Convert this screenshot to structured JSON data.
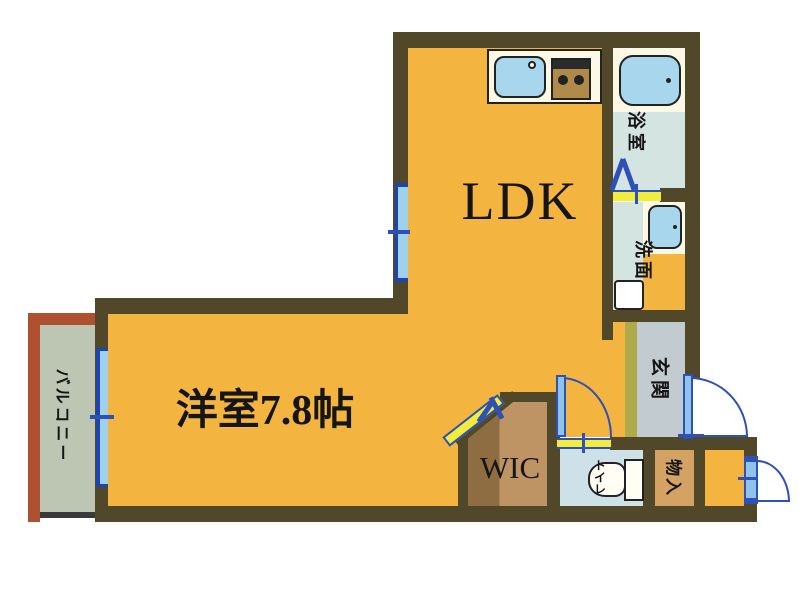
{
  "rooms": {
    "ldk": {
      "label": "LDK"
    },
    "bedroom": {
      "label": "洋室7.8帖"
    },
    "wic": {
      "label": "WIC"
    },
    "balcony": {
      "label": "バルコニー"
    },
    "bathroom": {
      "label": "浴室"
    },
    "washroom": {
      "label": "洗面"
    },
    "entrance": {
      "label": "玄関"
    },
    "storage": {
      "label": "物入"
    },
    "toilet": {
      "label": "トイレ"
    }
  },
  "fixtures": [
    "kitchen-sink",
    "gas-stove",
    "bathtub",
    "washbasin",
    "toilet-bowl",
    "washing-machine-pan"
  ],
  "doors": [
    "entrance-swing-door",
    "toilet-swing-door",
    "storage-swing-door",
    "bath-folding-door",
    "wic-folding-door"
  ],
  "windows": [
    "ldk-window",
    "balcony-sliding-window"
  ],
  "colors": {
    "wall": "#51482A",
    "floor_orange": "#F3B440",
    "wood": "#BE9464",
    "wood_dark": "#8F6D42",
    "bath_floor": "#D4E4E0",
    "toilet_floor": "#CEE1E8",
    "entry_gray": "#C2CBD0",
    "entry_olive": "#AFAA4B",
    "storage_tan": "#D4A263",
    "balcony_green": "#BDC6B2",
    "balcony_rust": "#AF5130",
    "door_blue": "#2D51B8",
    "leaf_blue": "#8FC4E8",
    "window_blue": "#9FD0EC",
    "window_dark": "#1C45B2",
    "threshold_yellow": "#F2EC3A",
    "fixture_blue": "#A8D6EC",
    "cream": "#FCF8E6",
    "outline": "#222222",
    "text": "#151515"
  }
}
